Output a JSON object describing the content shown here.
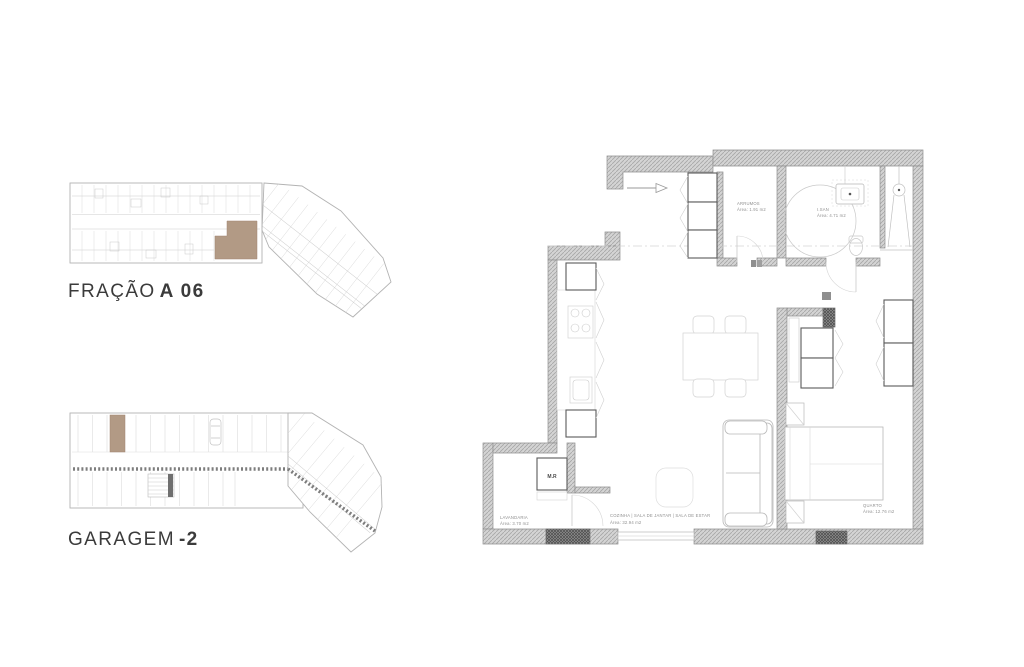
{
  "colors": {
    "background": "#ffffff",
    "highlight_brown": "#b29a85",
    "wall_fill": "#d2d2d2",
    "wall_hatch_line": "#a9a9a9",
    "wall_outline": "#8f8f8f",
    "furniture_light": "#c9c9c9",
    "furniture_bold": "#5a5a5a",
    "label_text": "#3b3b3b",
    "plan_text": "#8f8f8f"
  },
  "unit_label": {
    "prefix": "FRAÇÃO",
    "highlight": "A 06"
  },
  "garage_label": {
    "prefix": "GARAGEM",
    "highlight": "-2"
  },
  "floor_plan": {
    "rooms": [
      {
        "name": "ARRUMOS",
        "area": "Área: 1.91 m2"
      },
      {
        "name": "I.SAN",
        "area": "Área: 4.71 m2"
      },
      {
        "name": "LAVANDARIA",
        "area": "Área: 3.70 m2"
      },
      {
        "name": "COZINHA | SALA DE JANTAR | SALA DE ESTAR",
        "area": "Área: 32.94 m2"
      },
      {
        "name": "QUARTO",
        "area": "Área: 12.76 m2"
      }
    ],
    "labels": {
      "washing_machine": "M.R"
    }
  }
}
